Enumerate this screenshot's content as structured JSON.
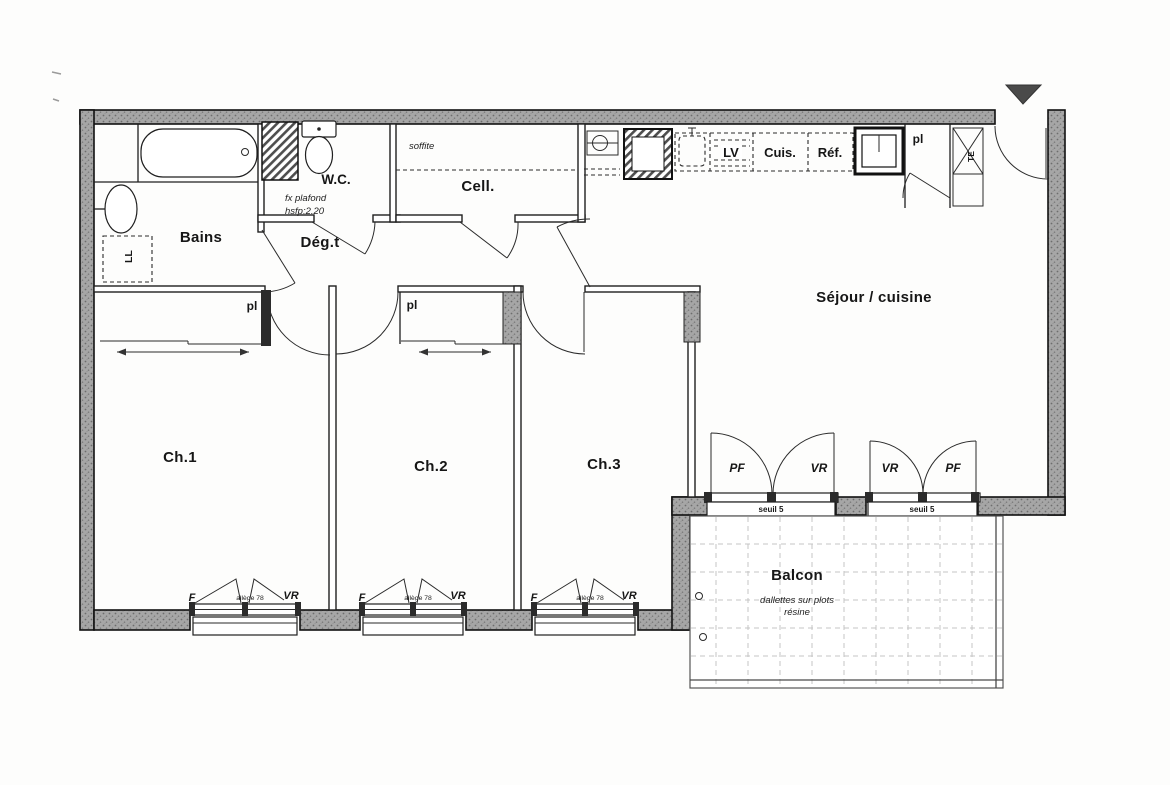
{
  "rooms": {
    "bains": "Bains",
    "wc": "W.C.",
    "degagement": "Dég.t",
    "cellier": "Cell.",
    "sejour": "Séjour / cuisine",
    "ch1": "Ch.1",
    "ch2": "Ch.2",
    "ch3": "Ch.3",
    "balcon": "Balcon"
  },
  "kitchen": {
    "lv": "LV",
    "cuisiniere": "Cuis.",
    "refrigerateur": "Réf."
  },
  "annotations": {
    "closet": "pl",
    "washer": "LL",
    "electrical_panel": "TE",
    "false_ceiling_1": "fx plafond",
    "false_ceiling_2": "hsfp:2.20",
    "soffit": "soffite",
    "threshold": "seuil 5",
    "balcony_note_1": "dallettes sur plots",
    "balcony_note_2": "résine",
    "window": "F",
    "shutter": "VR",
    "french_window": "PF",
    "sill_height": "allège 78"
  },
  "colors": {
    "wall_fill": "#a6a6a6",
    "line": "#1f1f1f",
    "paper": "#ffffff"
  }
}
